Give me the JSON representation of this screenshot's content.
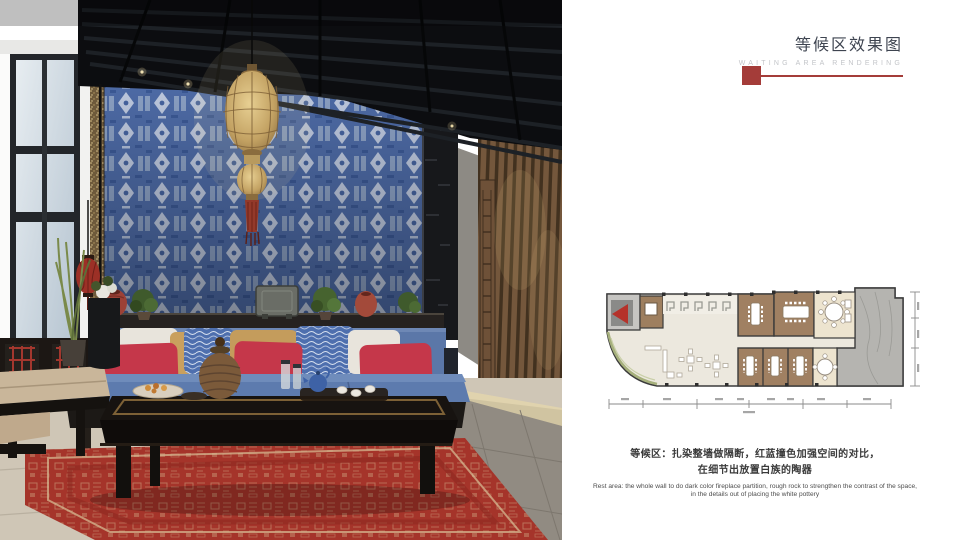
{
  "page": {
    "width": 960,
    "height": 540,
    "background": "#FFFFFF"
  },
  "header": {
    "title": "等候区效果图",
    "subtitle": "WAITING AREA RENDERING",
    "accent_color": "#A43C39",
    "title_color": "#3E4450",
    "subtitle_color": "#C3C5C9"
  },
  "photo": {
    "name": "waiting-area-interior-rendering",
    "palette": {
      "tapestry_blue": "#4D6AA5",
      "sofa_blue": "#5D7BAE",
      "pillow_red": "#C5374A",
      "rug_red": "#A5342A",
      "lantern_gold": "#C9A968",
      "wood_brown": "#74573C",
      "ceiling_black": "#0C0D10",
      "floor_beige": "#CFC6B6"
    }
  },
  "floor_plan": {
    "name": "hotel-floor-plan-thumbnail",
    "marker_icon": "red-entry-arrow",
    "marker_color": "#B5322A",
    "room_brown": "#A08062",
    "room_cream": "#EDE4CF",
    "terrace_marble": "#B5B4B0",
    "wall_color": "#3B3B3B"
  },
  "caption": {
    "cn_line1": "等候区：扎染整墙做隔断，红蓝撞色加强空间的对比，",
    "cn_line2": "在细节出放置白族的陶器",
    "en_line1": "Rest area: the whole wall to do dark color fireplace partition, rough rock to strengthen the contrast of the space,",
    "en_line2": "in the details out of placing the white pottery"
  }
}
